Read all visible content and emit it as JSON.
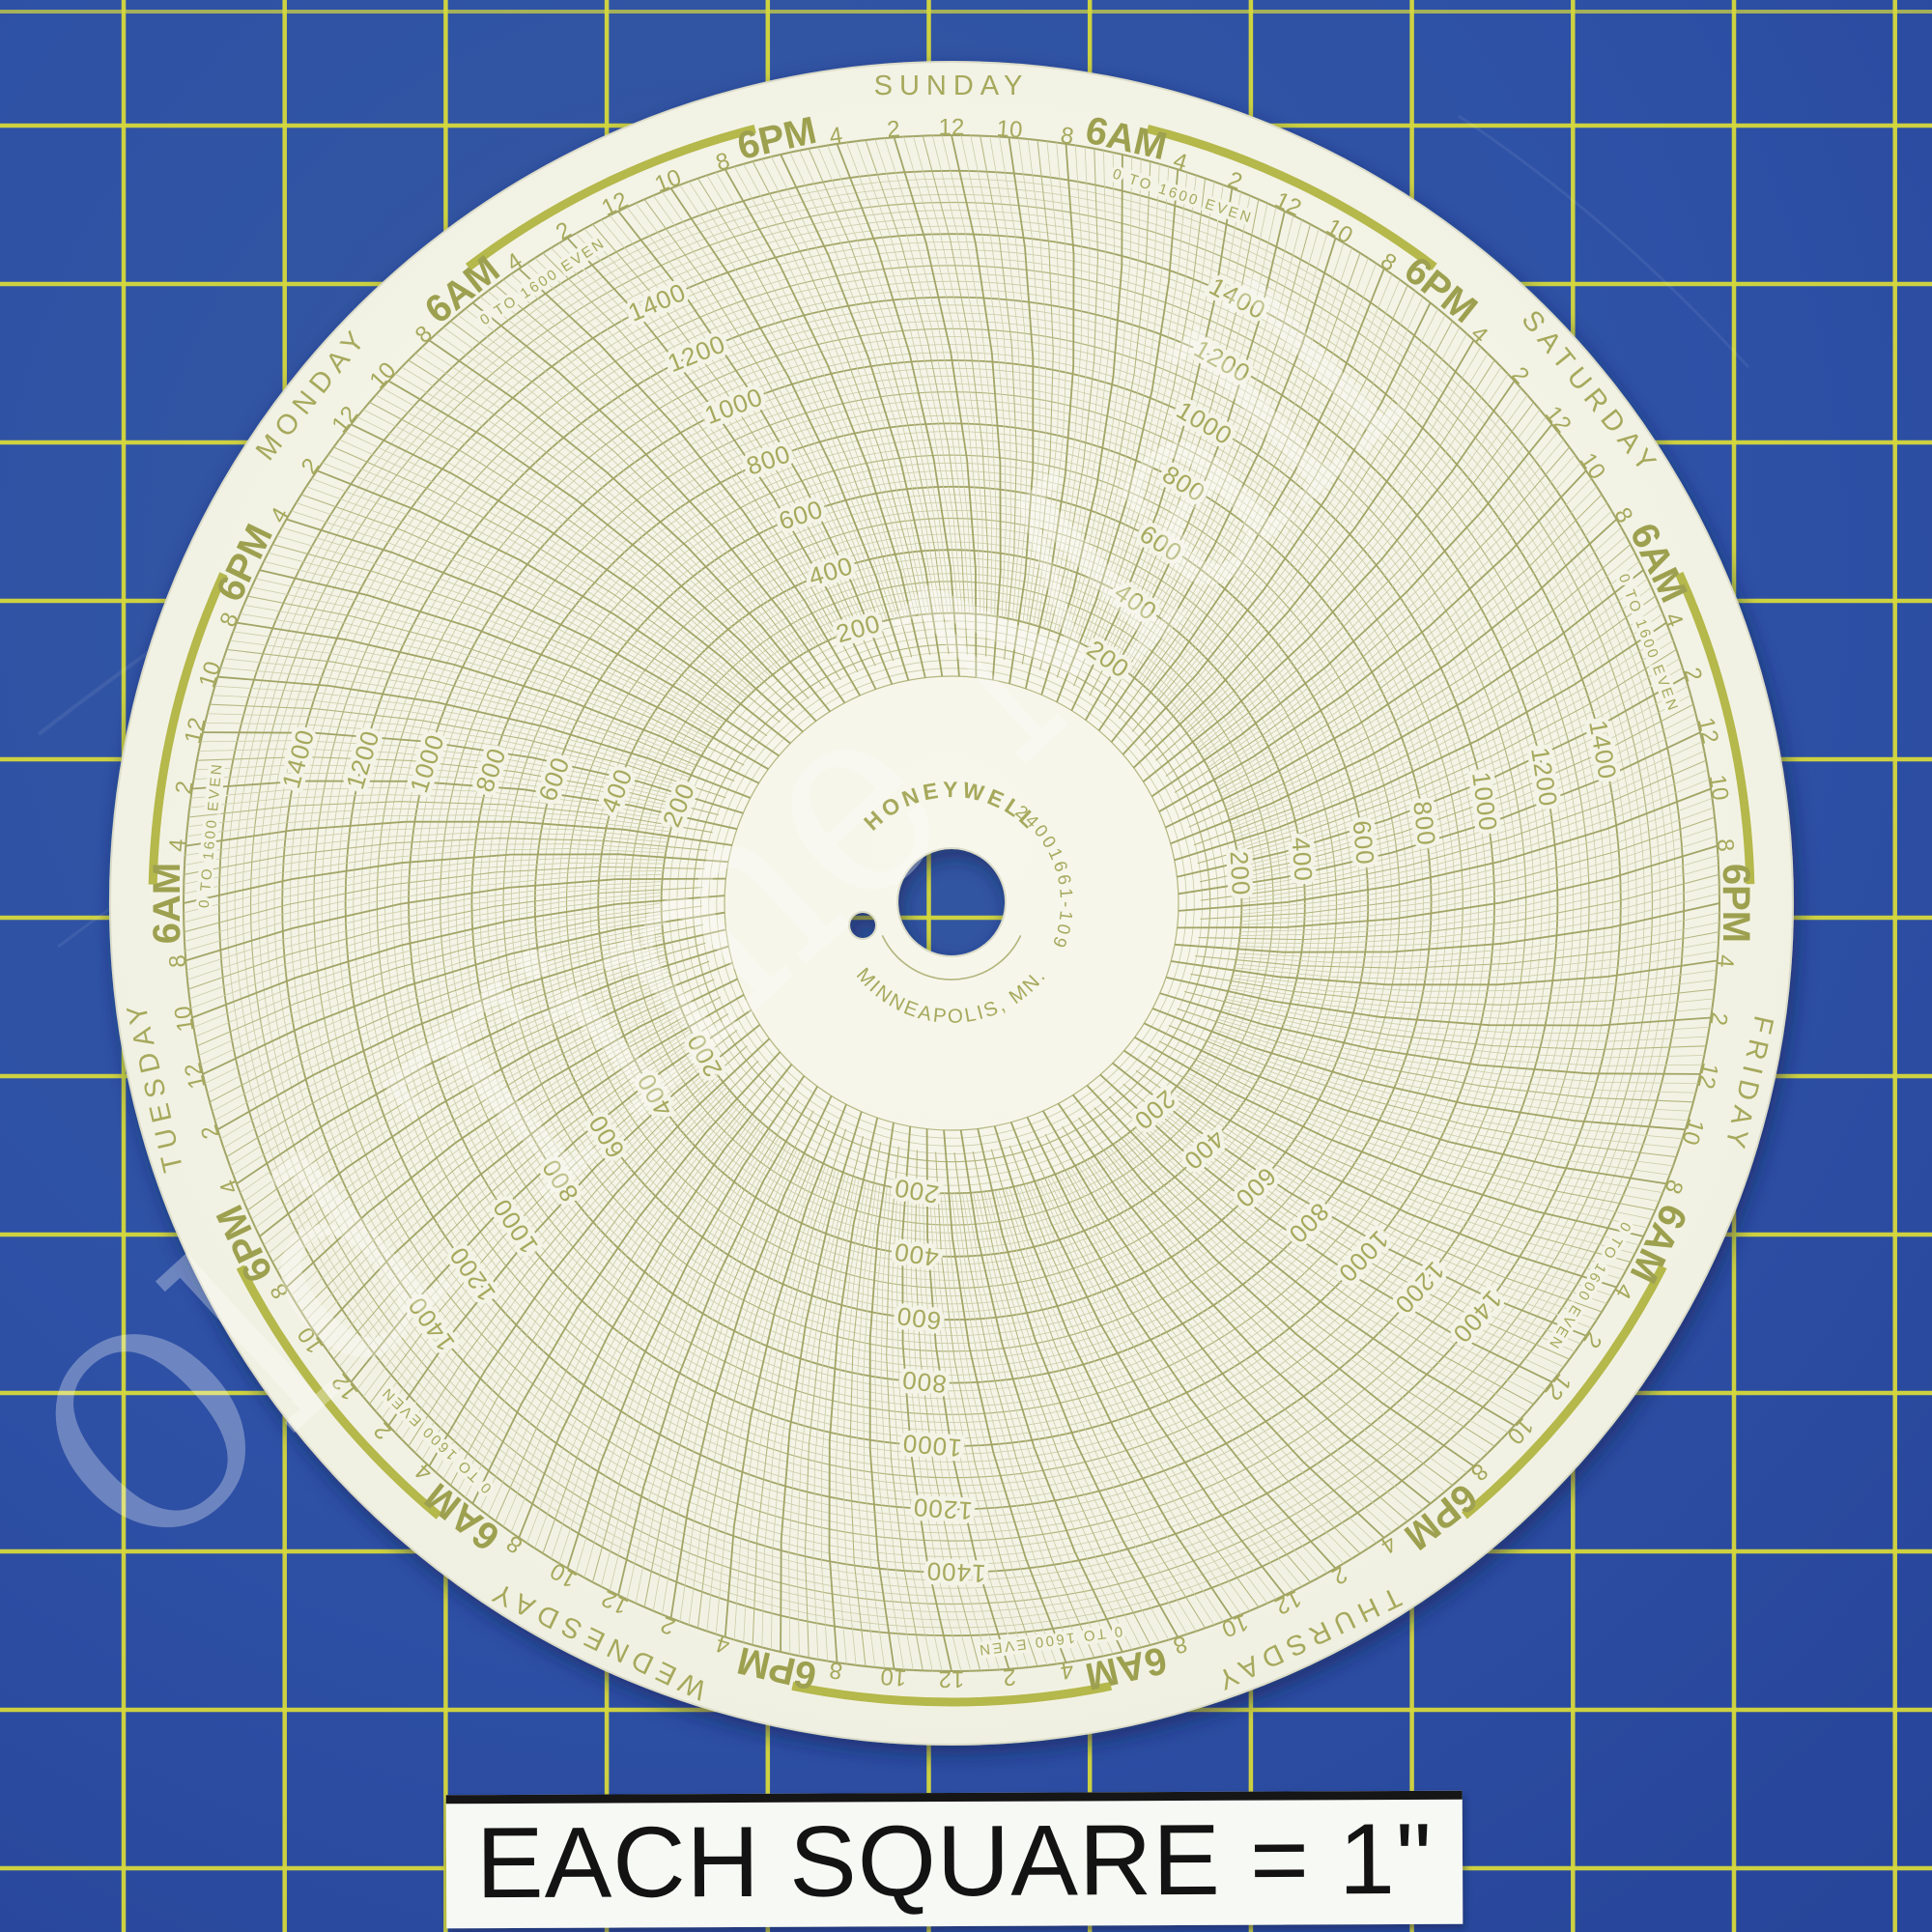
{
  "photo": {
    "subject": "Honeywell seven-day circular chart recorder paper lying on a blue self-healing cutting mat"
  },
  "mat": {
    "color": "#2e51a6",
    "grid_color": "#d6d93c",
    "caption_label": "EACH SQUARE = 1\""
  },
  "watermark": {
    "text": "Old Time Mall"
  },
  "disc": {
    "brand": "HONEYWELL",
    "part_number": "24001661-109",
    "city": "MINNEAPOLIS, MN.",
    "scale_note": "0 TO 1600 EVEN",
    "ink_color": "#a6a95c",
    "arc_color": "#b5b84a",
    "days_clockwise_from_top": [
      "SUNDAY",
      "SATURDAY",
      "FRIDAY",
      "THURSDAY",
      "WEDNESDAY",
      "TUESDAY",
      "MONDAY"
    ],
    "half_day_time_labels": [
      "12",
      "10",
      "8",
      "6AM",
      "4",
      "2",
      "12",
      "10",
      "8",
      "6PM",
      "4",
      "2"
    ],
    "value_ring_labels": [
      "1400",
      "1200",
      "1000",
      "800",
      "600",
      "400",
      "200"
    ]
  },
  "chart_data": {
    "type": "line",
    "title": "Honeywell 24001661-109 blank 7-day circular recorder chart, 0 to 1600 even",
    "angular_axis": {
      "unit": "time",
      "days": [
        "SUNDAY",
        "MONDAY",
        "TUESDAY",
        "WEDNESDAY",
        "THURSDAY",
        "FRIDAY",
        "SATURDAY"
      ],
      "tick_interval_hours": 2,
      "tick_labels_per_half_day": [
        "12",
        "10",
        "8",
        "6AM",
        "4",
        "2",
        "12",
        "10",
        "8",
        "6PM",
        "4",
        "2"
      ],
      "direction": "time increases counterclockwise, day names printed at noon positions"
    },
    "radial_axis": {
      "min": 0,
      "max": 1600,
      "label_step": 200,
      "labels": [
        200,
        400,
        600,
        800,
        1000,
        1200,
        1400
      ],
      "note": "0 TO 1600 EVEN"
    },
    "series": [],
    "legend": "none (unused blank chart paper, no recorded trace)"
  }
}
